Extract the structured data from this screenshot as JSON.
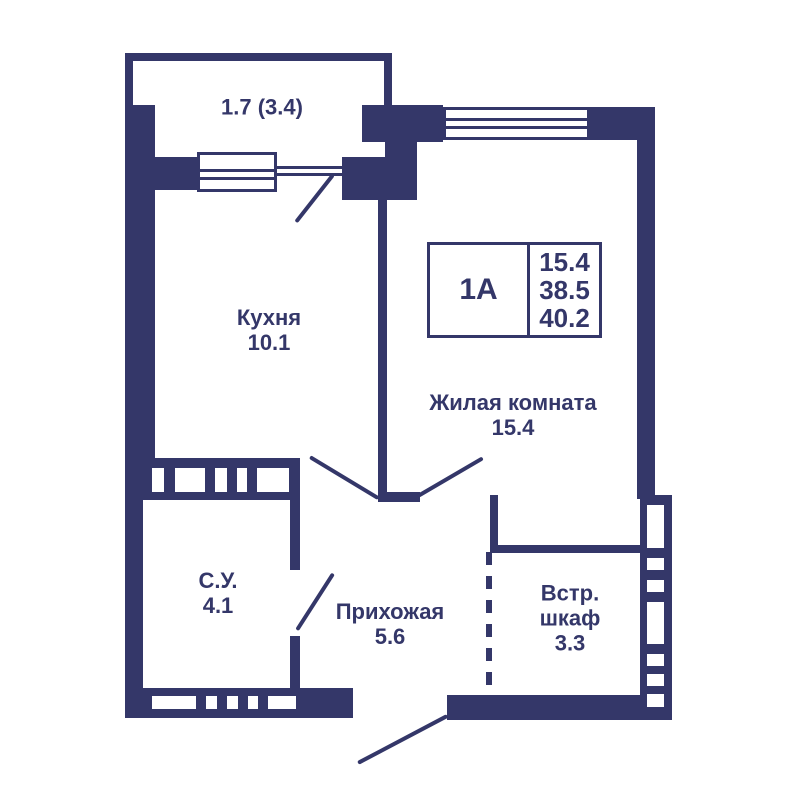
{
  "title": "Apartment floor plan 1A",
  "colors": {
    "wall": "#343769",
    "background": "#ffffff"
  },
  "unit_info": {
    "type": "1А",
    "living_area": "15.4",
    "area": "38.5",
    "total_area": "40.2"
  },
  "balcony": {
    "area_label": "1.7 (3.4)"
  },
  "rooms": {
    "kitchen": {
      "name": "Кухня",
      "area": "10.1"
    },
    "living_room": {
      "name": "Жилая комната",
      "area": "15.4"
    },
    "bathroom": {
      "name": "С.У.",
      "area": "4.1"
    },
    "hallway": {
      "name": "Прихожая",
      "area": "5.6"
    },
    "closet": {
      "name_line1": "Встр.",
      "name_line2": "шкаф",
      "area": "3.3"
    }
  }
}
